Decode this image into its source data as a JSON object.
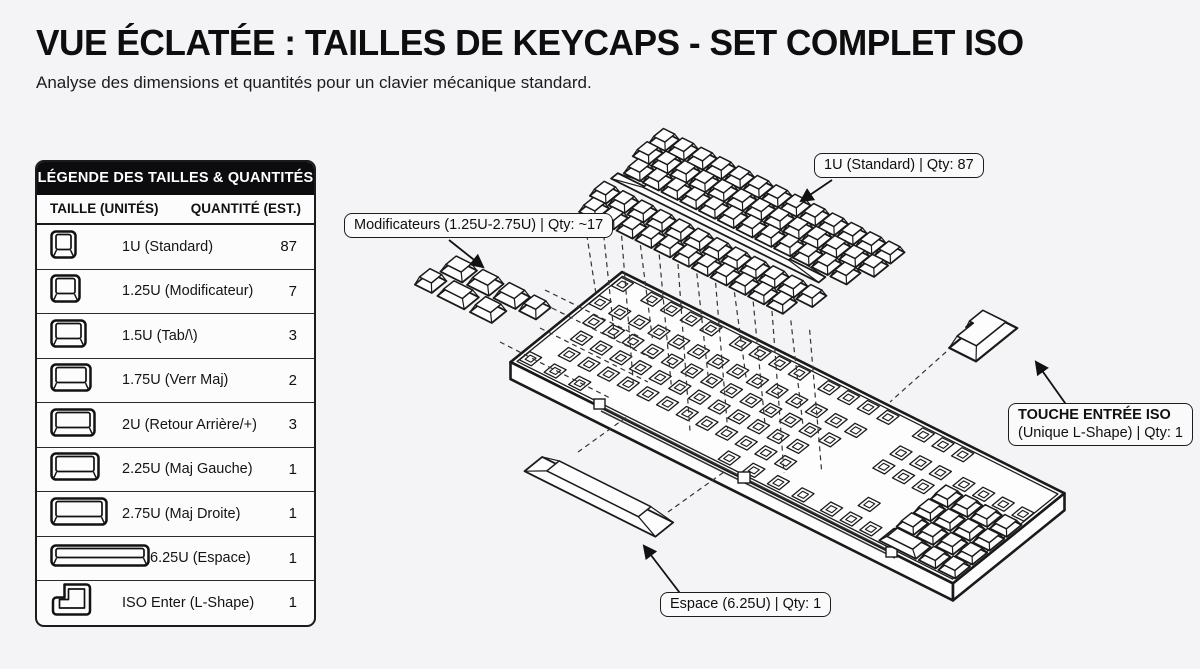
{
  "page": {
    "title": "VUE ÉCLATÉE : TAILLES DE KEYCAPS - SET COMPLET ISO",
    "subtitle": "Analyse des dimensions et quantités pour un clavier mécanique standard."
  },
  "legend": {
    "header": "LÉGENDE DES TAILLES & QUANTITÉS",
    "col_size": "TAILLE (UNITÉS)",
    "col_qty": "QUANTITÉ (EST.)",
    "rows": [
      {
        "icon": "keycap-1u",
        "label": "1U (Standard)",
        "qty": "87"
      },
      {
        "icon": "keycap-1-25u",
        "label": "1.25U (Modificateur)",
        "qty": "7"
      },
      {
        "icon": "keycap-1-5u",
        "label": "1.5U (Tab/\\)",
        "qty": "3"
      },
      {
        "icon": "keycap-1-75u",
        "label": "1.75U (Verr Maj)",
        "qty": "2"
      },
      {
        "icon": "keycap-2u",
        "label": "2U (Retour Arrière/+)",
        "qty": "3"
      },
      {
        "icon": "keycap-2-25u",
        "label": "2.25U (Maj Gauche)",
        "qty": "1"
      },
      {
        "icon": "keycap-2-75u",
        "label": "2.75U (Maj Droite)",
        "qty": "1"
      },
      {
        "icon": "keycap-6-25u",
        "label": "6.25U (Espace)",
        "qty": "1"
      },
      {
        "icon": "keycap-iso-enter",
        "label": "ISO Enter (L-Shape)",
        "qty": "1"
      }
    ]
  },
  "callouts": {
    "standard": "1U (Standard) | Qty: 87",
    "modifiers": "Modificateurs (1.25U-2.75U) | Qty: ~17",
    "iso_title": "TOUCHE ENTRÉE ISO",
    "iso_sub": "(Unique L-Shape) | Qty: 1",
    "space": "Espace (6.25U) | Qty: 1"
  }
}
